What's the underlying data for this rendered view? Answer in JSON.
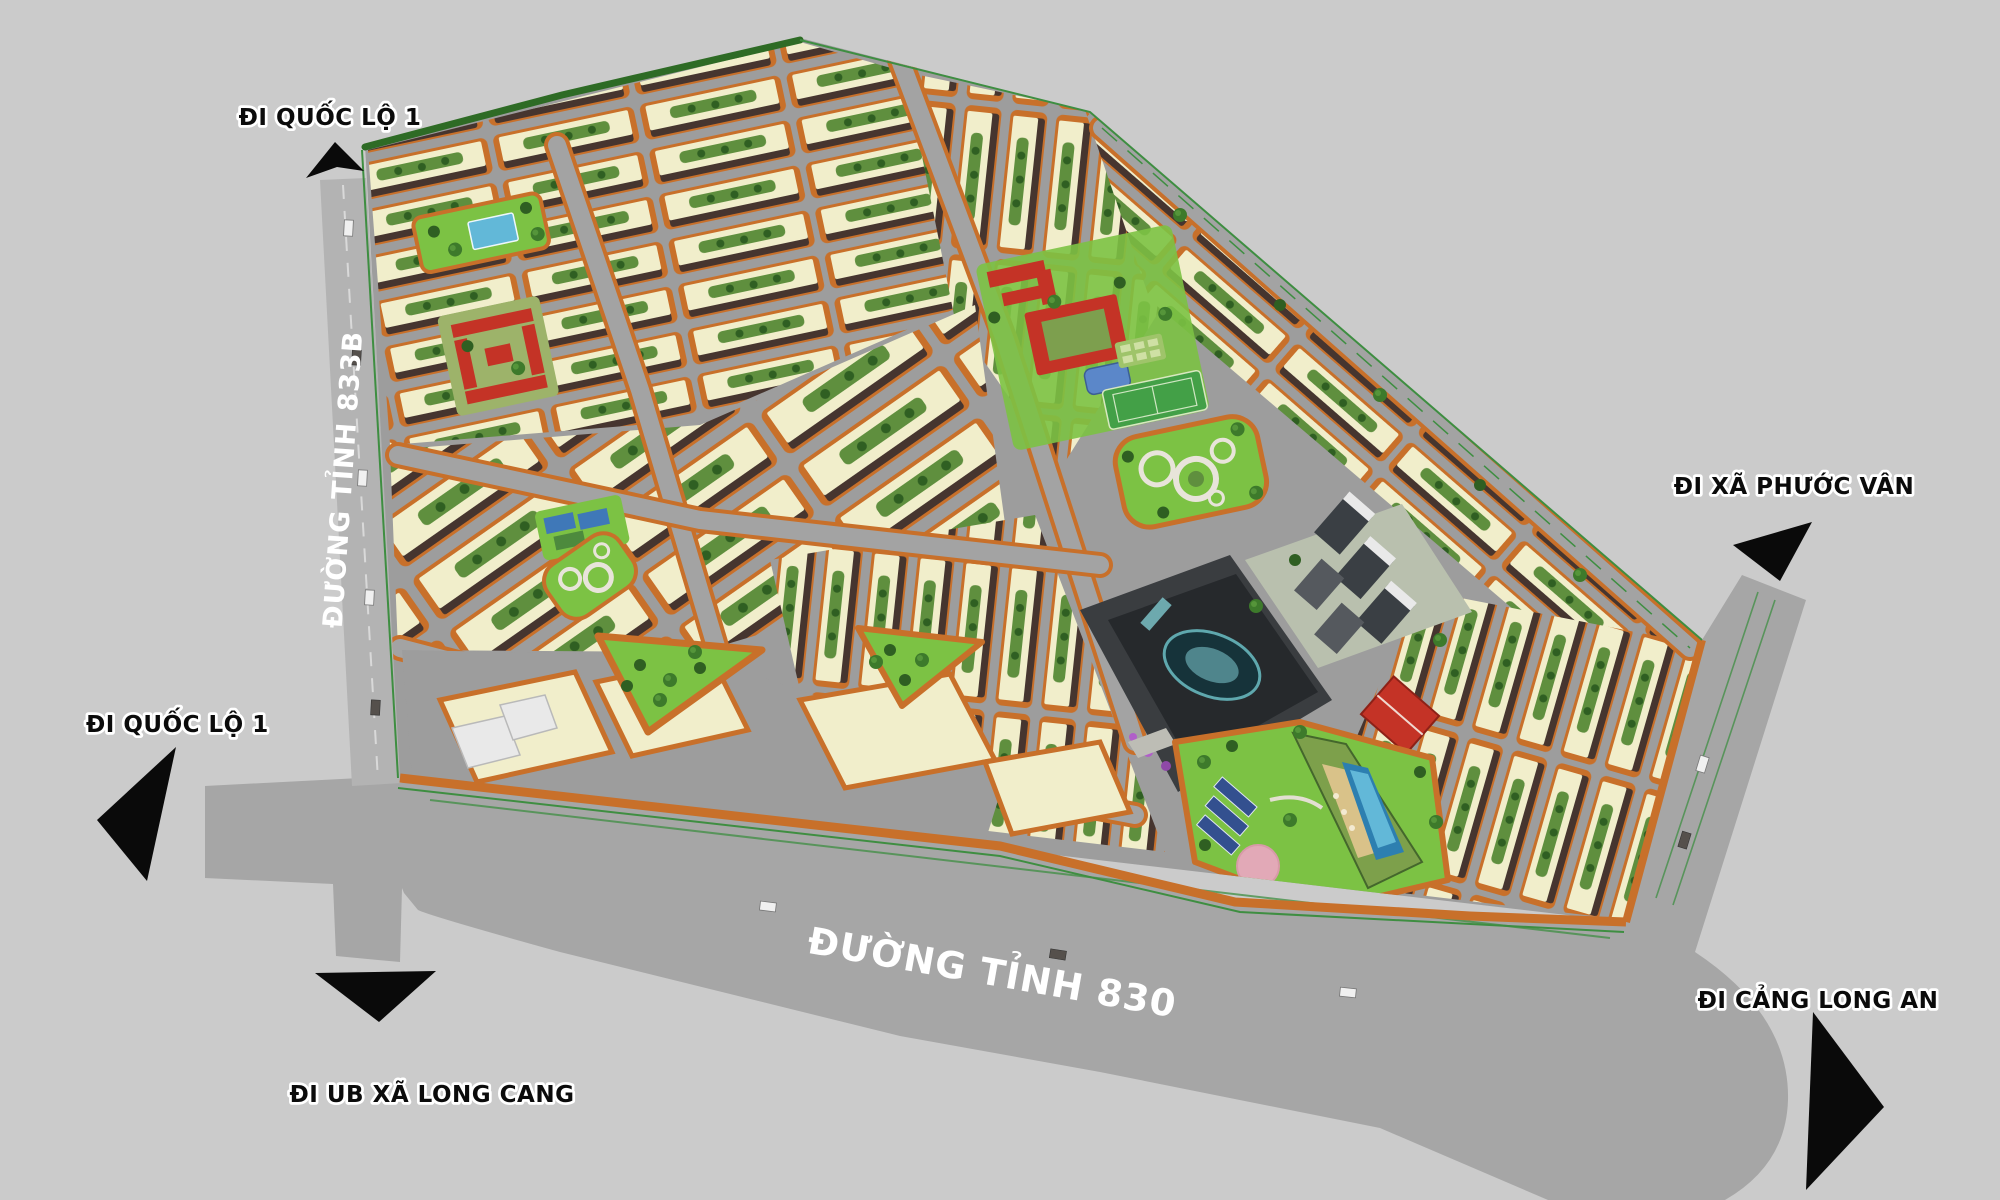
{
  "scene": {
    "description": "3D aerial master-plan rendering of a planned urban residential development with grid blocks, parks, school campus, commercial landmark and clubhouse",
    "view": "isometric aerial"
  },
  "roads": {
    "dt833b": {
      "name": "ĐƯỜNG TỈNH 833B"
    },
    "dt830": {
      "name": "ĐƯỜNG TỈNH 830"
    }
  },
  "directions": [
    {
      "id": "quoc-lo-1-north",
      "label": "ĐI QUỐC LỘ 1",
      "arrow": "up-left"
    },
    {
      "id": "quoc-lo-1-west",
      "label": "ĐI QUỐC LỘ 1",
      "arrow": "down-left"
    },
    {
      "id": "ub-xa-long-cang",
      "label": "ĐI UB XÃ LONG CANG",
      "arrow": "down"
    },
    {
      "id": "xa-phuoc-van",
      "label": "ĐI XÃ PHƯỚC VÂN",
      "arrow": "up-right"
    },
    {
      "id": "cang-long-an",
      "label": "ĐI CẢNG LONG AN",
      "arrow": "right"
    }
  ],
  "features": [
    "shophouse-row-blocks",
    "temple-complex-red-roofs",
    "school-campus-red-roofs",
    "sports-hall-blue-roof",
    "football-field",
    "circular-garden-park",
    "triangular-parks",
    "commercial-landmark-dark-building",
    "apartment-towers",
    "clubhouse-with-pool",
    "pink-event-plaza",
    "solar-panel-carpark",
    "warehouse-bigbox-zone",
    "tree-lined-boundary"
  ],
  "palette": {
    "bg": "#cbcbcb",
    "road": "#a6a6a6",
    "roadLight": "#a3a3a3",
    "siteBase": "#9d9d9d",
    "sidewalk": "#c8702a",
    "roof": "#f1eecb",
    "facade": "#46352f",
    "park": "#7cc244",
    "courtGreen": "#5f8f3e",
    "tree": "#3d7a2b",
    "treeDark": "#2f5f22",
    "field": "#43a047",
    "pool": "#62b8d8",
    "poolDeep": "#2d7fb0",
    "sand": "#d9c289",
    "pink": "#e2a9b7",
    "solar": "#33508f",
    "dark": "#26292c",
    "teal": "#7fc9cf",
    "tower": "#3a3f44",
    "white": "#e9e9e9",
    "greenLine": "#3e8e41",
    "red": "#c43326"
  }
}
